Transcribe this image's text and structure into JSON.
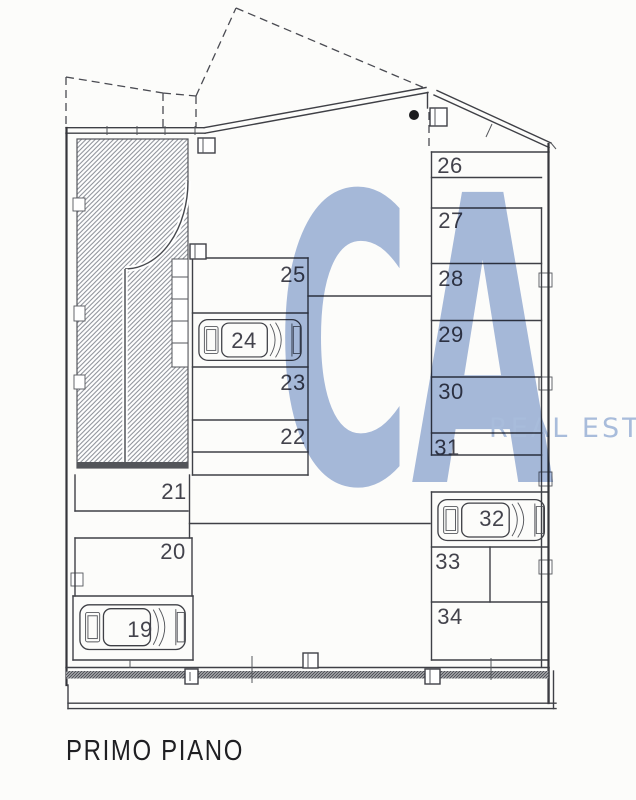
{
  "page": {
    "title": "PRIMO PIANO"
  },
  "watermark": {
    "logo_text": "CA",
    "wordmark_text": "REAL EST",
    "color": "#a7badd",
    "wordmark_color": "#aabee0"
  },
  "floor_plan": {
    "spaces": [
      {
        "label": "19",
        "has_car": true
      },
      {
        "label": "20",
        "has_car": false
      },
      {
        "label": "21",
        "has_car": false
      },
      {
        "label": "22",
        "has_car": false
      },
      {
        "label": "23",
        "has_car": false
      },
      {
        "label": "24",
        "has_car": true
      },
      {
        "label": "25",
        "has_car": false
      },
      {
        "label": "26",
        "has_car": false
      },
      {
        "label": "27",
        "has_car": false
      },
      {
        "label": "28",
        "has_car": false
      },
      {
        "label": "29",
        "has_car": false
      },
      {
        "label": "30",
        "has_car": false
      },
      {
        "label": "31",
        "has_car": false
      },
      {
        "label": "32",
        "has_car": true
      },
      {
        "label": "33",
        "has_car": false
      },
      {
        "label": "34",
        "has_car": false
      }
    ]
  },
  "colors": {
    "paper": "#fcfcfa",
    "line": "#3f4046",
    "hatch": "#888c94",
    "watermark_blue": "#a7badd"
  }
}
